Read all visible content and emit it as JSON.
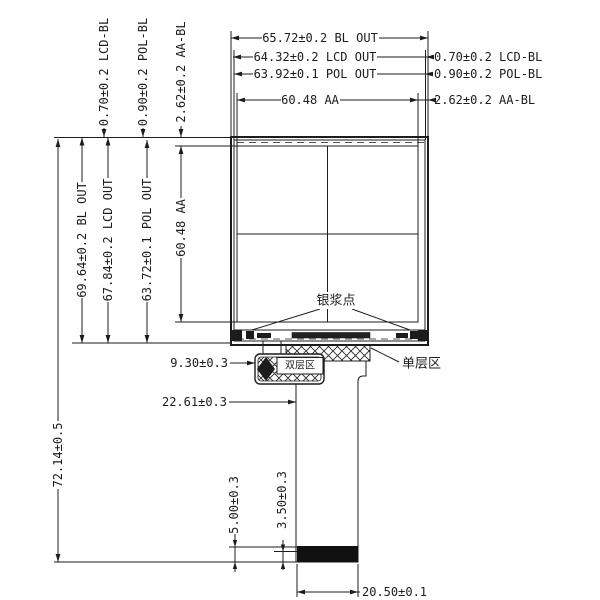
{
  "drawing_title": "LCD module outline drawing",
  "top_dims": {
    "bl_out": "65.72±0.2 BL OUT",
    "lcd_out": "64.32±0.2 LCD OUT",
    "pol_out": "63.92±0.1 POL OUT",
    "aa": "60.48 AA"
  },
  "right_gap_dims": {
    "lcd_bl": "0.70±0.2 LCD-BL",
    "pol_bl": "0.90±0.2 POL-BL",
    "aa_bl": "2.62±0.2 AA-BL"
  },
  "left_gap_dims": {
    "lcd_bl": "0.70±0.2 LCD-BL",
    "pol_bl": "0.90±0.2 POL-BL",
    "aa_bl": "2.62±0.2 AA-BL"
  },
  "left_dims": {
    "bl_out": "69.64±0.2 BL OUT",
    "lcd_out": "67.84±0.2 LCD OUT",
    "pol_out": "63.72±0.1 POL OUT",
    "aa": "60.48 AA",
    "total": "72.14±0.5"
  },
  "fpc_dims": {
    "w930": "9.30±0.3",
    "w2261": "22.61±0.3",
    "h500": "5.00±0.3",
    "h350": "3.50±0.3",
    "w2050": "20.50±0.1"
  },
  "labels": {
    "silver_paste": "银浆点",
    "single_layer": "单层区",
    "double_layer": "双层区"
  },
  "colors": {
    "line": "#1c1c1c",
    "background": "#ffffff",
    "stiffener": "#111111"
  }
}
